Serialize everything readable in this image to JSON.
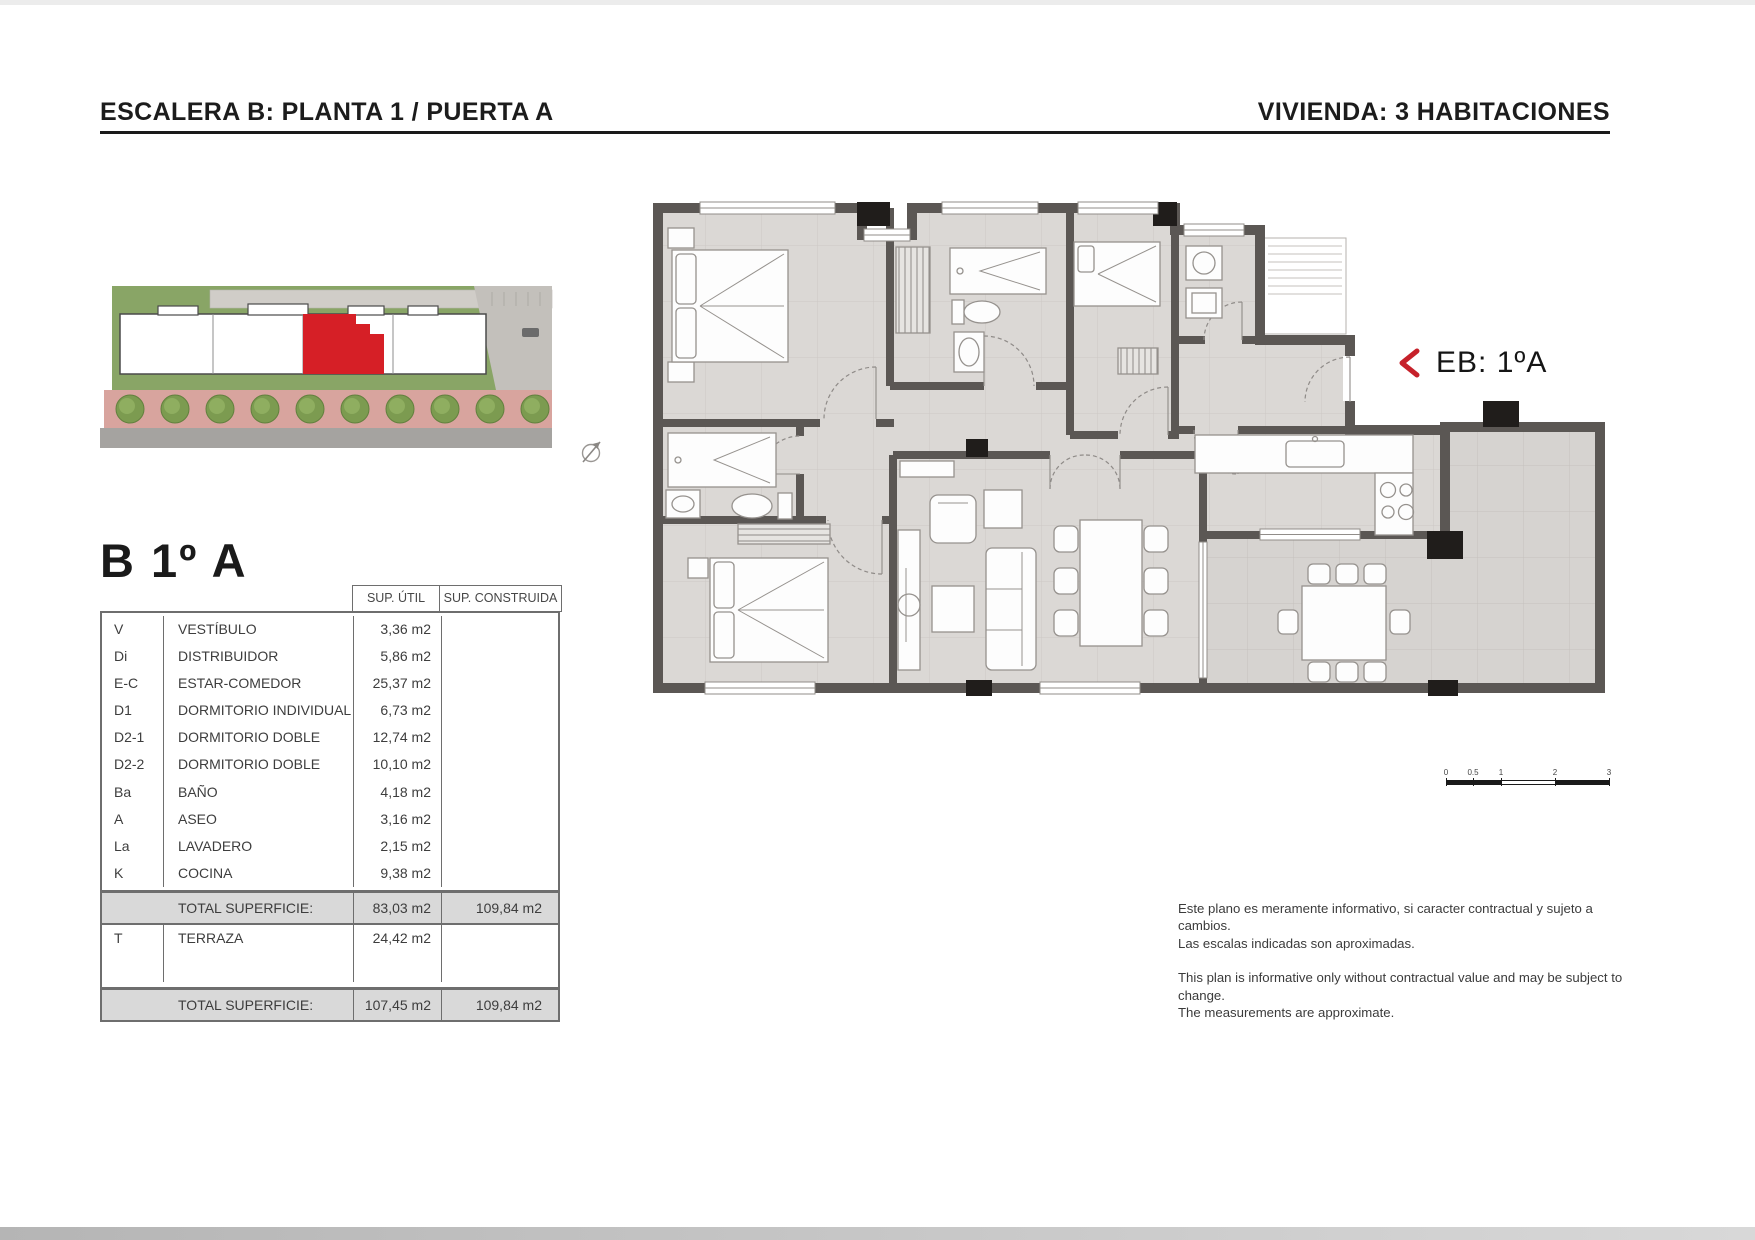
{
  "header": {
    "left_title": "ESCALERA B: PLANTA 1 / PUERTA A",
    "right_title": "VIVIENDA: 3 HABITACIONES"
  },
  "unit": {
    "title": "B 1º A",
    "plan_label": "EB: 1ºA"
  },
  "areas_table": {
    "col_util": "SUP. ÚTIL",
    "col_construida": "SUP. CONSTRUIDA",
    "rows": [
      {
        "code": "V",
        "name": "VESTÍBULO",
        "util": "3,36 m2",
        "construida": ""
      },
      {
        "code": "Di",
        "name": "DISTRIBUIDOR",
        "util": "5,86 m2",
        "construida": ""
      },
      {
        "code": "E-C",
        "name": "ESTAR-COMEDOR",
        "util": "25,37 m2",
        "construida": ""
      },
      {
        "code": "D1",
        "name": "DORMITORIO INDIVIDUAL",
        "util": "6,73 m2",
        "construida": ""
      },
      {
        "code": "D2-1",
        "name": "DORMITORIO DOBLE",
        "util": "12,74 m2",
        "construida": ""
      },
      {
        "code": "D2-2",
        "name": "DORMITORIO DOBLE",
        "util": "10,10 m2",
        "construida": ""
      },
      {
        "code": "Ba",
        "name": "BAÑO",
        "util": "4,18 m2",
        "construida": ""
      },
      {
        "code": "A",
        "name": "ASEO",
        "util": "3,16 m2",
        "construida": ""
      },
      {
        "code": "La",
        "name": "LAVADERO",
        "util": "2,15 m2",
        "construida": ""
      },
      {
        "code": "K",
        "name": "COCINA",
        "util": "9,38 m2",
        "construida": ""
      }
    ],
    "total_interior": {
      "label": "TOTAL SUPERFICIE:",
      "util": "83,03 m2",
      "construida": "109,84 m2"
    },
    "terraza": {
      "code": "T",
      "name": "TERRAZA",
      "util": "24,42 m2",
      "construida": ""
    },
    "total_general": {
      "label": "TOTAL SUPERFICIE:",
      "util": "107,45 m2",
      "construida": "109,84 m2"
    }
  },
  "scale_bar": {
    "ticks": [
      "0",
      "0.5",
      "1",
      "2",
      "3"
    ]
  },
  "disclaimer": {
    "es_line1": "Este plano es meramente informativo, si caracter contractual y sujeto a cambios.",
    "es_line2": "Las escalas indicadas son aproximadas.",
    "en_line1": "This plan is informative only without contractual value and may be subject to change.",
    "en_line2": "The measurements are approximate."
  },
  "colors": {
    "accent_red": "#c6212a",
    "site_unit_red": "#d61f26",
    "wall_grey": "#5b5754",
    "floor_grey": "#dbd8d5",
    "site_green": "#89a566"
  }
}
